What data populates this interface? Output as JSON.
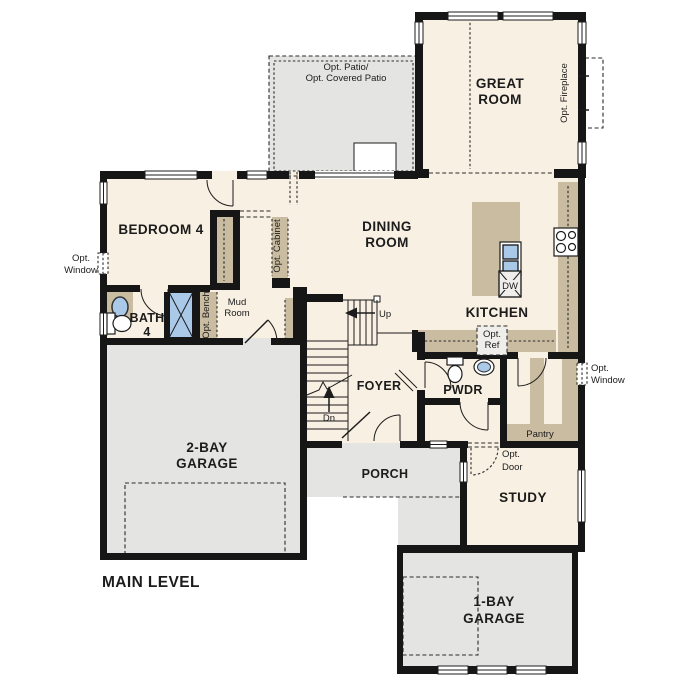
{
  "plan": {
    "level_title": "MAIN LEVEL"
  },
  "rooms": {
    "great_room": {
      "l1": "GREAT",
      "l2": "ROOM"
    },
    "dining_room": {
      "l1": "DINING",
      "l2": "ROOM"
    },
    "kitchen": {
      "label": "KITCHEN"
    },
    "bedroom_4": {
      "label": "BEDROOM 4"
    },
    "bath_4": {
      "l1": "BATH",
      "l2": "4"
    },
    "mud_room": {
      "l1": "Mud",
      "l2": "Room"
    },
    "foyer": {
      "label": "FOYER"
    },
    "powder": {
      "label": "PWDR"
    },
    "pantry": {
      "label": "Pantry"
    },
    "study": {
      "label": "STUDY"
    },
    "porch": {
      "label": "PORCH"
    },
    "garage_2bay": {
      "l1": "2-BAY",
      "l2": "GARAGE"
    },
    "garage_1bay": {
      "l1": "1-BAY",
      "l2": "GARAGE"
    },
    "patio": {
      "l1": "Opt. Patio/",
      "l2": "Opt. Covered Patio"
    }
  },
  "options": {
    "fireplace": "Opt. Fireplace",
    "window_left": {
      "l1": "Opt.",
      "l2": "Window"
    },
    "window_right": {
      "l1": "Opt.",
      "l2": "Window"
    },
    "door": {
      "l1": "Opt.",
      "l2": "Door"
    },
    "ref": {
      "l1": "Opt.",
      "l2": "Ref"
    },
    "bench": "Opt. Bench",
    "cabinet": "Opt. Cabinet"
  },
  "stairs": {
    "up": "Up",
    "dn": "Dn"
  },
  "appliances": {
    "dishwasher": "DW"
  },
  "colors": {
    "floor": "#f8f0e2",
    "hard": "#e4e4e2",
    "cabinet": "#c9bca1",
    "fixture": "#aac9e9",
    "wall": "#161616",
    "appliance": "#efeeea"
  }
}
